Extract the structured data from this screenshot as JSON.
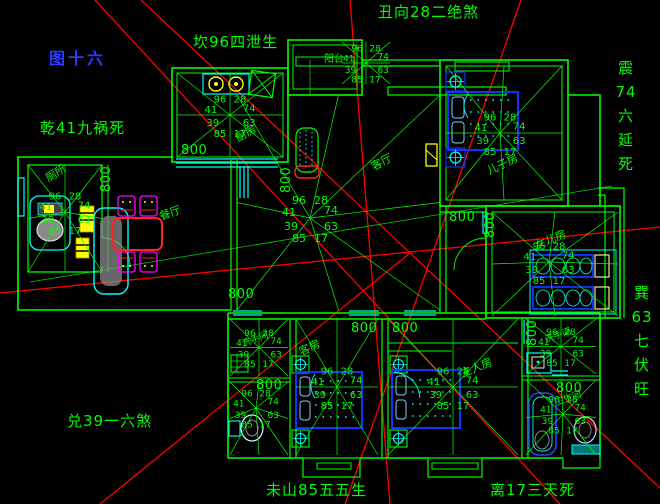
{
  "figure_title": {
    "text": "图十六",
    "color": "#2a3cff"
  },
  "perimeter_labels": [
    {
      "id": "kan",
      "text": "坎96四泄生"
    },
    {
      "id": "chou",
      "text": "丑向28二绝煞"
    },
    {
      "id": "qian",
      "text": "乾41九祸死"
    },
    {
      "id": "zhen",
      "text": "震\n74\n六\n延\n死"
    },
    {
      "id": "xun",
      "text": "巽\n63\n七\n伏\n旺"
    },
    {
      "id": "dui",
      "text": "兑39一六煞"
    },
    {
      "id": "wei",
      "text": "未山85五五生"
    },
    {
      "id": "li",
      "text": "离17三天死"
    }
  ],
  "room_labels": [
    {
      "id": "kitchen",
      "text": "厨房"
    },
    {
      "id": "toilet",
      "text": "厕所"
    },
    {
      "id": "living",
      "text": "客厅"
    },
    {
      "id": "dining",
      "text": "餐厅"
    },
    {
      "id": "balcony",
      "text": "阳台"
    },
    {
      "id": "son-room",
      "text": "儿子房"
    },
    {
      "id": "daughter-room",
      "text": "女儿房"
    },
    {
      "id": "guest-room",
      "text": "客房"
    },
    {
      "id": "master-room",
      "text": "主人房"
    },
    {
      "id": "washroom-left",
      "text": "洗手间"
    },
    {
      "id": "washroom-right",
      "text": "洗手间"
    },
    {
      "id": "bath-right",
      "text": "卫生间"
    }
  ],
  "star_values": [
    "96",
    "28",
    "41",
    "74",
    "39",
    "63",
    "85",
    "17"
  ],
  "stars": [
    {
      "id": "kitchen",
      "bbox": [
        177,
        73,
        283,
        157
      ],
      "fs": 10
    },
    {
      "id": "toilet",
      "bbox": [
        28,
        165,
        102,
        272
      ],
      "cx": 65,
      "cy": 212,
      "fs": 10
    },
    {
      "id": "living",
      "bbox": [
        237,
        95,
        440,
        310
      ],
      "cx": 310,
      "cy": 218,
      "fs": 11
    },
    {
      "id": "entry",
      "bbox": [
        342,
        42,
        390,
        84
      ],
      "fs": 9
    },
    {
      "id": "son",
      "bbox": [
        446,
        66,
        562,
        200
      ],
      "cx": 500,
      "cy": 133,
      "fs": 10
    },
    {
      "id": "daughter",
      "bbox": [
        492,
        212,
        618,
        316
      ],
      "cx": 549,
      "cy": 262,
      "fs": 10
    },
    {
      "id": "guest",
      "bbox": [
        296,
        319,
        378,
        455
      ],
      "fs": 10
    },
    {
      "id": "master",
      "bbox": [
        388,
        319,
        518,
        455
      ],
      "fs": 10
    },
    {
      "id": "bath-l-top",
      "bbox": [
        230,
        319,
        288,
        376
      ],
      "fs": 9
    },
    {
      "id": "bath-l-bot",
      "bbox": [
        230,
        382,
        288,
        455
      ],
      "cx": 256,
      "cy": 408,
      "fs": 9
    },
    {
      "id": "bath-r-top",
      "bbox": [
        526,
        319,
        596,
        374
      ],
      "fs": 9
    },
    {
      "id": "bath-r-bot",
      "bbox": [
        526,
        380,
        596,
        455
      ],
      "cx": 563,
      "cy": 414,
      "fs": 9
    }
  ],
  "dim_labels": [
    {
      "text": "800",
      "x": 110,
      "y": 192,
      "rot": -90
    },
    {
      "text": "800",
      "x": 181,
      "y": 154
    },
    {
      "text": "800",
      "x": 290,
      "y": 193,
      "rot": -90
    },
    {
      "text": "800",
      "x": 228,
      "y": 298
    },
    {
      "text": "800",
      "x": 351,
      "y": 332
    },
    {
      "text": "800",
      "x": 392,
      "y": 332
    },
    {
      "text": "800",
      "x": 449,
      "y": 221
    },
    {
      "text": "800",
      "x": 494,
      "y": 238,
      "rot": -90
    },
    {
      "text": "800",
      "x": 536,
      "y": 346,
      "rot": -90
    },
    {
      "text": "800",
      "x": 556,
      "y": 392
    },
    {
      "text": "800",
      "x": 256,
      "y": 389
    }
  ],
  "colors": {
    "wall": "#00ff00",
    "window": "#00ffff",
    "compass_line": "#ff0000",
    "bed": "#1133ff",
    "table": "#ff2222",
    "chair": "#ff00ff",
    "fixture": "#00ffff",
    "appliance": "#ffff00",
    "gray": "#8a8a8a",
    "text": "#00ff00",
    "title": "#2a3cff"
  }
}
